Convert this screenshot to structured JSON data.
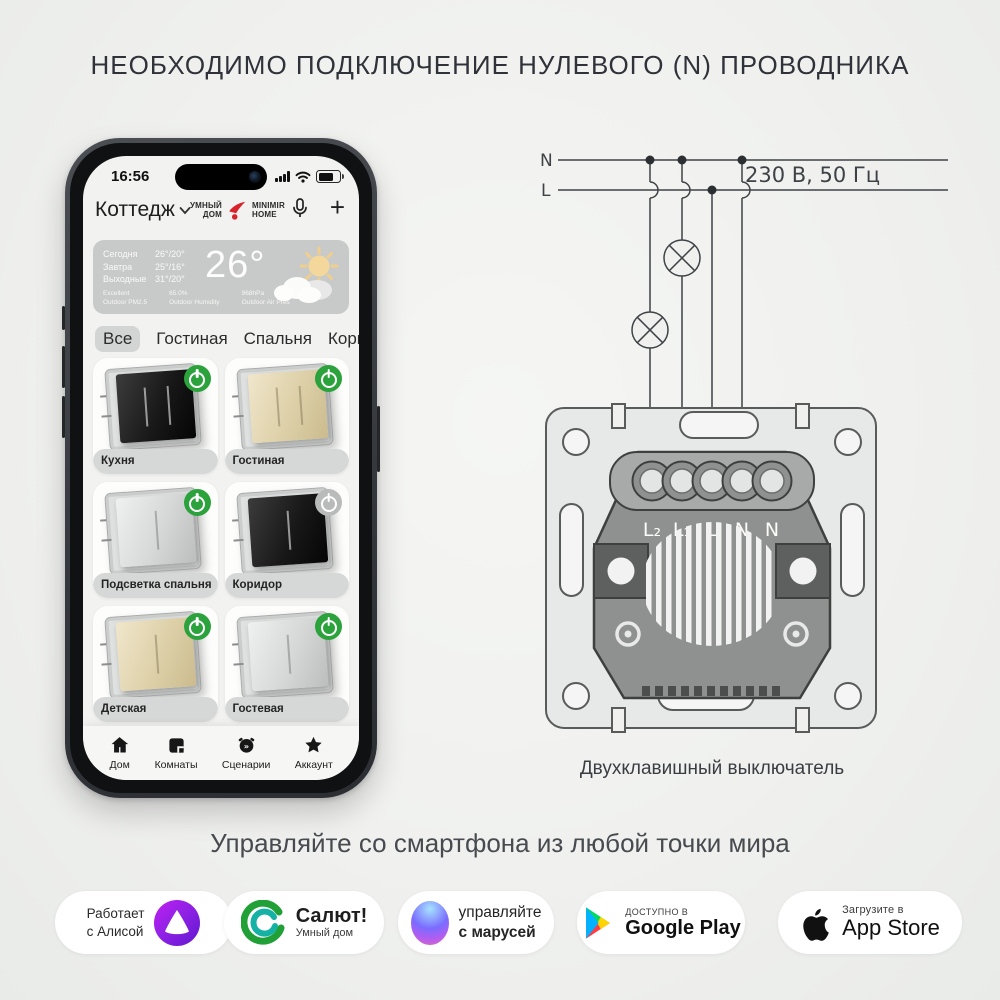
{
  "page": {
    "title": "НЕОБХОДИМО ПОДКЛЮЧЕНИЕ НУЛЕВОГО (N) ПРОВОДНИКА",
    "tagline": "Управляйте со смартфона из любой точки мира"
  },
  "phone": {
    "status": {
      "time": "16:56"
    },
    "header": {
      "home_name": "Коттедж",
      "brand_left_line1": "УМНЫЙ",
      "brand_left_line2": "ДОМ",
      "brand_right_line1": "MINIMIR",
      "brand_right_line2": "HOME"
    },
    "weather": {
      "forecast": [
        {
          "label": "Сегодня",
          "temp": "26°/20°"
        },
        {
          "label": "Завтра",
          "temp": "25°/16°"
        },
        {
          "label": "Выходные",
          "temp": "31°/20°"
        }
      ],
      "current_temp": "26°",
      "stats": [
        {
          "value": "Excellent",
          "label": "Outdoor PM2.5"
        },
        {
          "value": "65.0%",
          "label": "Outdoor Humidity"
        },
        {
          "value": "968hPa",
          "label": "Outdoor Air Pres"
        }
      ]
    },
    "tabs": [
      {
        "label": "Все",
        "active": true
      },
      {
        "label": "Гостиная",
        "active": false
      },
      {
        "label": "Спальня",
        "active": false
      },
      {
        "label": "Коридор",
        "active": false
      }
    ],
    "cards": [
      {
        "name": "Кухня",
        "color": "black",
        "lines": 2,
        "on": true
      },
      {
        "name": "Гостиная",
        "color": "champagne",
        "lines": 2,
        "on": true
      },
      {
        "name": "Подсветка спальня",
        "color": "silver",
        "lines": 1,
        "on": true
      },
      {
        "name": "Коридор",
        "color": "black",
        "lines": 1,
        "on": false
      },
      {
        "name": "Детская",
        "color": "champagne",
        "lines": 1,
        "on": true
      },
      {
        "name": "Гостевая",
        "color": "silver",
        "lines": 1,
        "on": true
      }
    ],
    "partial_cards": 2,
    "nav": [
      {
        "label": "Дом",
        "icon": "home-icon"
      },
      {
        "label": "Комнаты",
        "icon": "rooms-icon"
      },
      {
        "label": "Сценарии",
        "icon": "scenarios-icon"
      },
      {
        "label": "Аккаунт",
        "icon": "account-icon"
      }
    ]
  },
  "diagram": {
    "n_label": "N",
    "l_label": "L",
    "voltage": "230 В, 50 Гц",
    "terminals": [
      "L₂",
      "L₁",
      "L",
      "N",
      "N"
    ],
    "caption": "Двухклавишный выключатель"
  },
  "badges": {
    "alisa": {
      "line1": "Работает",
      "line2": "с Алисой"
    },
    "salut": {
      "title": "Салют!",
      "subtitle": "Умный дом"
    },
    "marusya": {
      "line1": "управляйте",
      "line2": "с марусей"
    },
    "google": {
      "small": "ДОСТУПНО В",
      "big": "Google Play"
    },
    "apple": {
      "small": "Загрузите в",
      "big": "App Store"
    }
  },
  "colors": {
    "power_on": "#2ba23c",
    "power_off": "#b9bbba",
    "brand_red": "#d9232a",
    "accent_green": "#21a038"
  }
}
